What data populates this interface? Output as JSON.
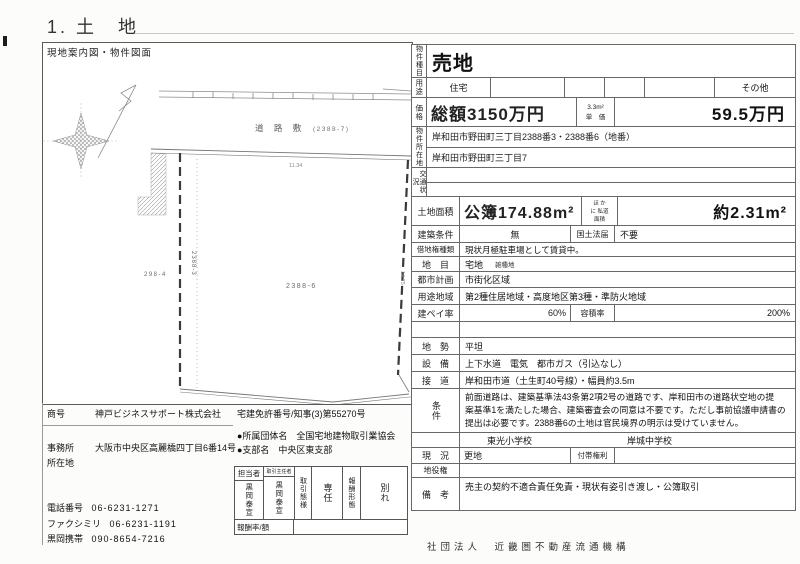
{
  "page": {
    "title": "1. 土　地",
    "footer": "社団法人　近畿圏不動産流通機構",
    "ink_color": "#222222",
    "paper_color": "#ffffff",
    "border_color": "#686868"
  },
  "map": {
    "panel_label": "現地案内図・物件図面",
    "road_label": "道 路 敷",
    "road_parcel": "(2388-7)",
    "parcel_main": "2388-6",
    "parcel_sub": "2388-3",
    "parcel_neighbor": "298-4",
    "dim_top": "11.34",
    "dim_right": "14.75"
  },
  "property": {
    "type_label": "物件種目",
    "type_value": "売地",
    "use_label": "用途",
    "use_cells": [
      "住宅",
      "",
      "",
      "",
      "",
      "その他"
    ],
    "price_label": "価格",
    "price_total": "総額3150万円",
    "price_unit_line1": "3.3m²",
    "price_unit_line2": "単　価",
    "price_unit_value": "59.5万円",
    "location_label": "物件所在地",
    "location_line1": "岸和田市野田町三丁目2388番3・2388番6（地番）",
    "location_line2": "岸和田市野田町三丁目7",
    "access_label": "交通状況",
    "area_label": "土地面積",
    "area_value": "公簿174.88m²",
    "private_road_line1": "ほ か",
    "private_road_line2": "に 私道",
    "private_road_line3": "面積",
    "private_road_value": "約2.31m²",
    "build_cond_label": "建築条件",
    "build_cond_value": "無",
    "kokudo_label": "国土法届",
    "kokudo_value": "不要",
    "leasehold_label": "借地権種類",
    "leasehold_value": "現状月極駐車場として賃貸中。",
    "chimoku_label": "地　目",
    "chimoku_value": "宅地",
    "chimoku_note": "雑種地",
    "city_plan_label": "都市計画",
    "city_plan_value": "市街化区域",
    "zoning_label": "用途地域",
    "zoning_value": "第2種住居地域・高度地区第3種・準防火地域",
    "coverage_label": "建ペイ率",
    "coverage_value": "60%",
    "far_label": "容積率",
    "far_value": "200%",
    "terrain_label": "地　勢",
    "terrain_value": "平坦",
    "utilities_label": "設　備",
    "utilities_value": "上下水道　電気　都市ガス（引込なし）",
    "road_label": "接　道",
    "road_value": "岸和田市道（土生町40号線）・幅員約3.5m",
    "cond_label": "条件",
    "cond_line1": "前面道路は、建築基準法43条第2項2号の道路です、岸和田市の道路状空地の提",
    "cond_line2": "案基準1を満たした場合、建築審査会の同意は不要です。ただし事前協議申請書の",
    "cond_line3": "提出は必要です。2388番6の土地は官民境界の明示は受けていません。",
    "school_elementary": "東光小学校",
    "school_junior": "岸城中学校",
    "state_label": "現　況",
    "state_value": "更地",
    "rights_label": "付帯権利",
    "rights_value": "",
    "easement_label": "地役権",
    "easement_value": "",
    "remarks_label": "備　考",
    "remarks_value": "売主の契約不適合責任免責・現状有姿引き渡し・公簿取引"
  },
  "agency": {
    "name_label": "商号",
    "name": "神戸ビジネスサポート株式会社",
    "license": "宅建免許番号/知事(3)第55270号",
    "association": "●所属団体名　全国宅地建物取引業協会",
    "office_label1": "事務所",
    "office_label2": "所在地",
    "office": "大阪市中央区高麗橋四丁目6番14号",
    "branch": "●支部名　中央区東支部",
    "phone_label": "電話番号",
    "phone": "06-6231-1271",
    "fax_label": "ファクシミリ",
    "fax": "06-6231-1191",
    "mobile_label": "黒岡携帯",
    "mobile": "090-8654-7216",
    "staff_label": "担当者",
    "staff_name": "黒岡泰宣",
    "chief_label": "取引主任者",
    "chief_name": "黒岡泰宣",
    "mode_label": "取引態様",
    "mode_value": "専任",
    "fee_label": "報酬形態",
    "fee_value": "別れ",
    "fee_rate_label": "報酬率/額"
  }
}
